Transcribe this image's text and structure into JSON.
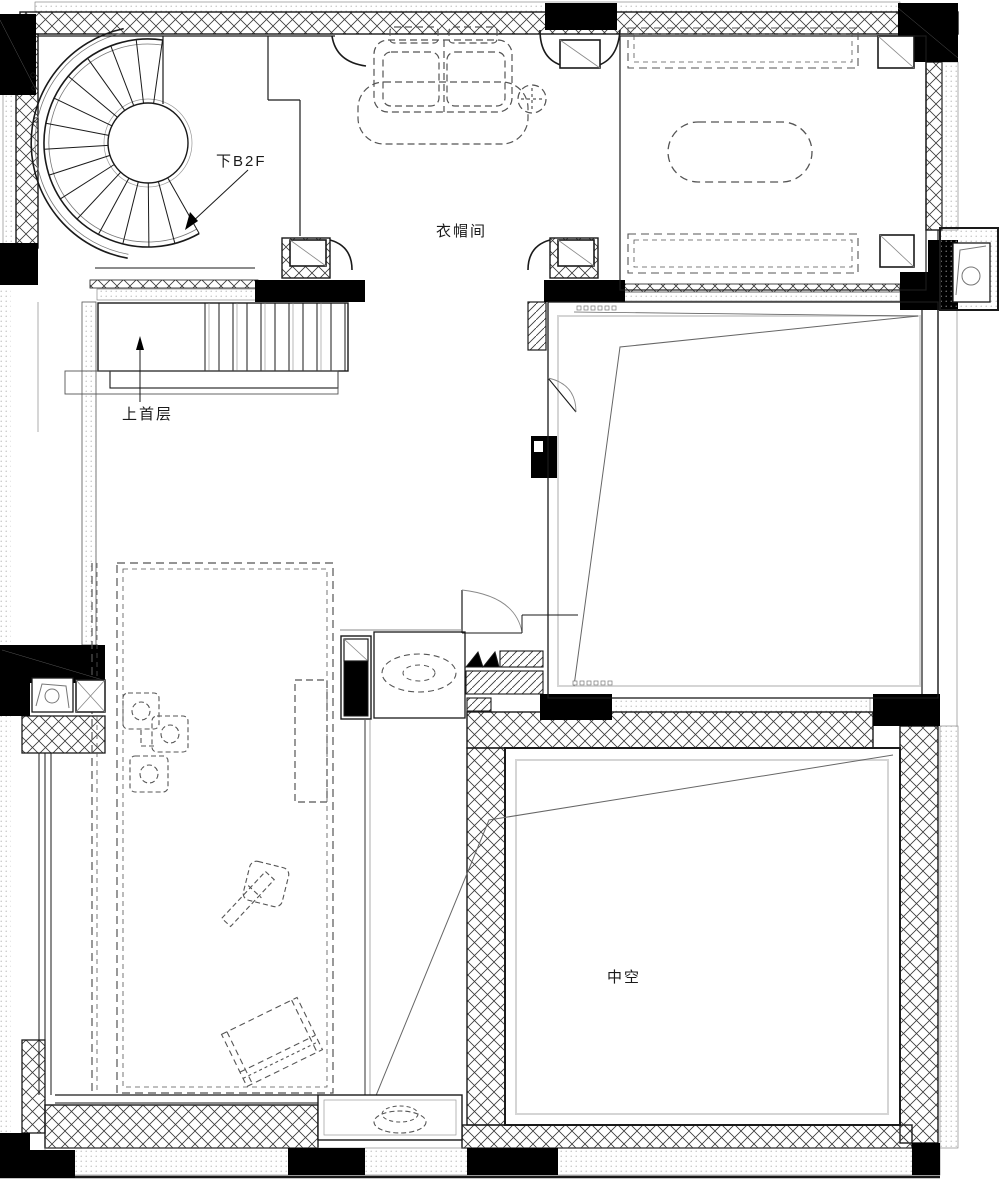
{
  "floorplan": {
    "labels": {
      "stair_down": "下B2F",
      "cloakroom": "衣帽间",
      "stair_up": "上首层",
      "void_space": "中空"
    },
    "colors": {
      "line": "#1a1a1a",
      "hatch_line": "#3a3a3a",
      "stipple_dot": "#aaaaaa",
      "column_fill": "#000000",
      "dashed_furniture": "#555555",
      "background": "#ffffff"
    }
  }
}
